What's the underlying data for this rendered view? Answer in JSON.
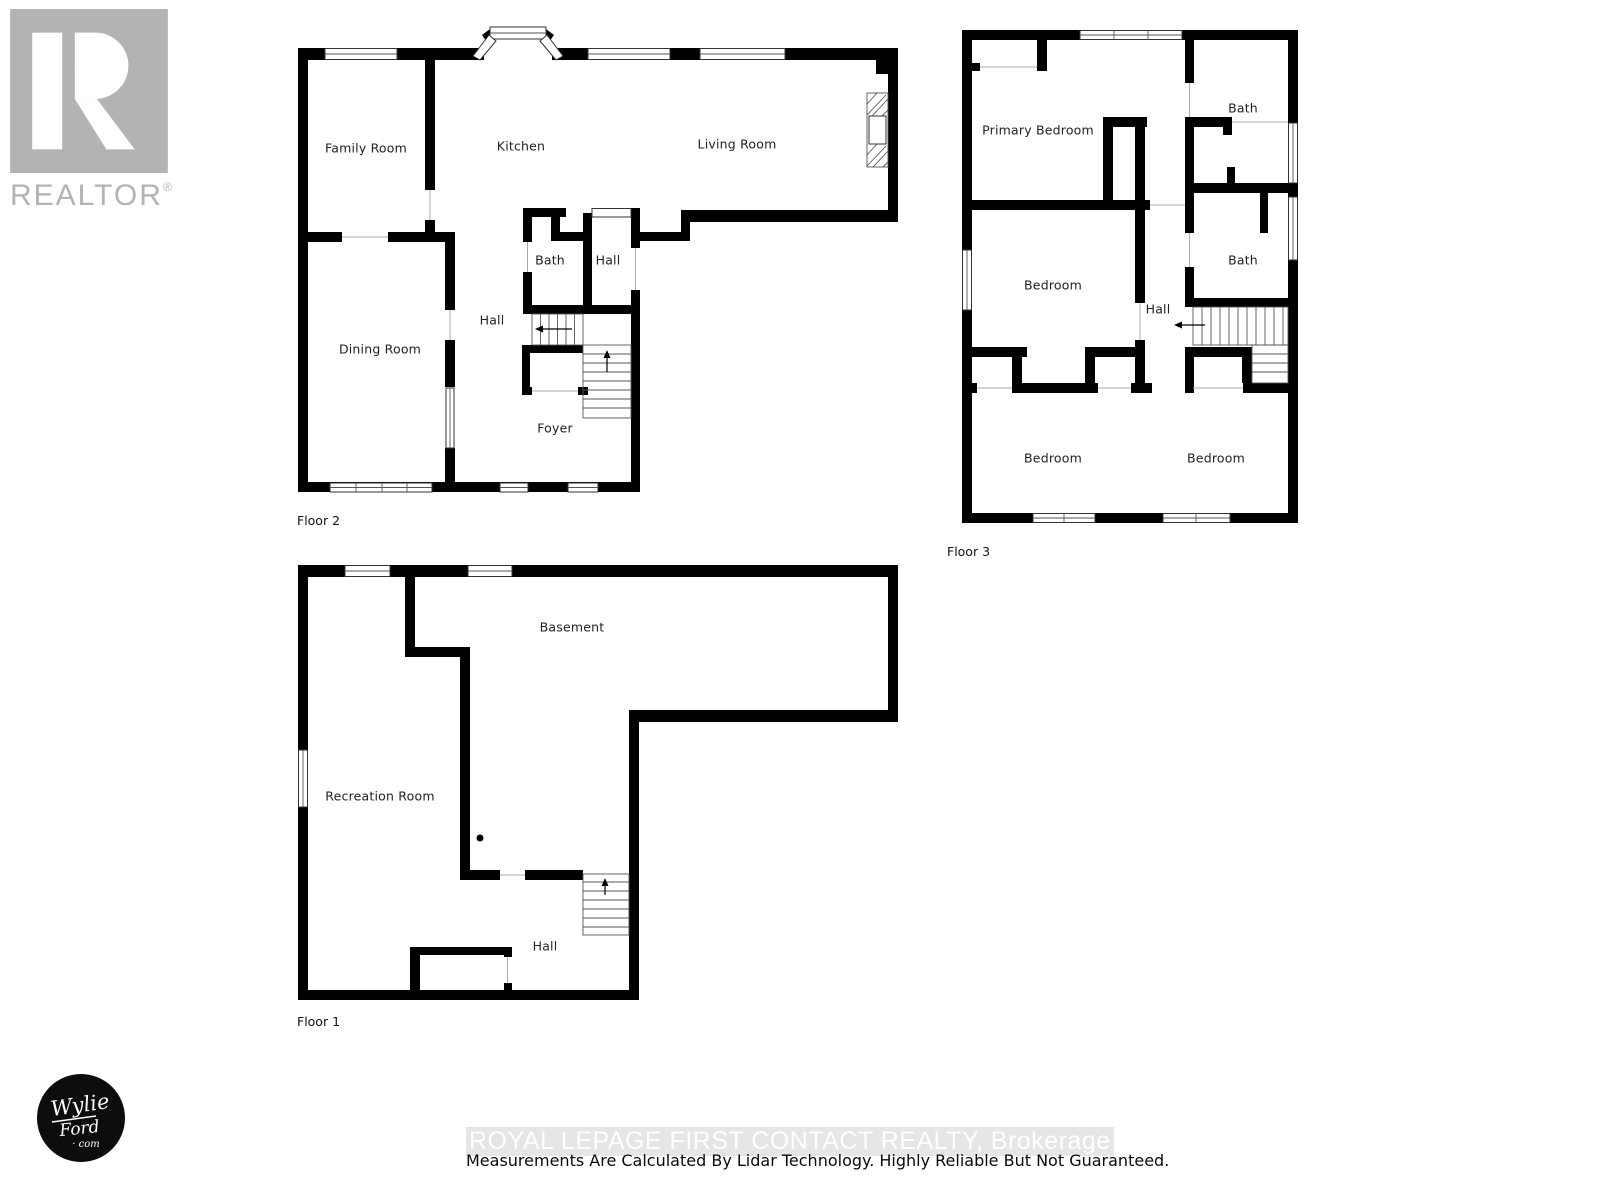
{
  "branding": {
    "realtor_wordmark": "REALTOR",
    "registered_mark": "®",
    "badge": {
      "line1": "Wylie",
      "line2": "Ford",
      "line3": "· com"
    }
  },
  "footer": {
    "watermark": "ROYAL LEPAGE FIRST CONTACT REALTY, Brokerage",
    "disclaimer": "Measurements Are Calculated By Lidar Technology. Highly Reliable But Not Guaranteed."
  },
  "floors": {
    "floor2": {
      "label": "Floor 2",
      "rooms": {
        "family_room": "Family Room",
        "kitchen": "Kitchen",
        "living_room": "Living Room",
        "bath": "Bath",
        "hall_upper": "Hall",
        "hall_lower": "Hall",
        "dining_room": "Dining Room",
        "foyer": "Foyer"
      }
    },
    "floor3": {
      "label": "Floor 3",
      "rooms": {
        "primary_bedroom": "Primary Bedroom",
        "bath_upper": "Bath",
        "bedroom_mid": "Bedroom",
        "bath_lower": "Bath",
        "hall": "Hall",
        "bedroom_bottom_left": "Bedroom",
        "bedroom_bottom_right": "Bedroom"
      }
    },
    "floor1": {
      "label": "Floor 1",
      "rooms": {
        "basement": "Basement",
        "recreation_room": "Recreation Room",
        "hall": "Hall"
      }
    }
  },
  "colors": {
    "wall": "#000000",
    "thin": "#555555",
    "door": "#aaaaaa",
    "label": "#222222",
    "logo-gray": "#b3b3b3",
    "wm-bg": "#e6e6e6",
    "wm-text": "#ffffff"
  }
}
